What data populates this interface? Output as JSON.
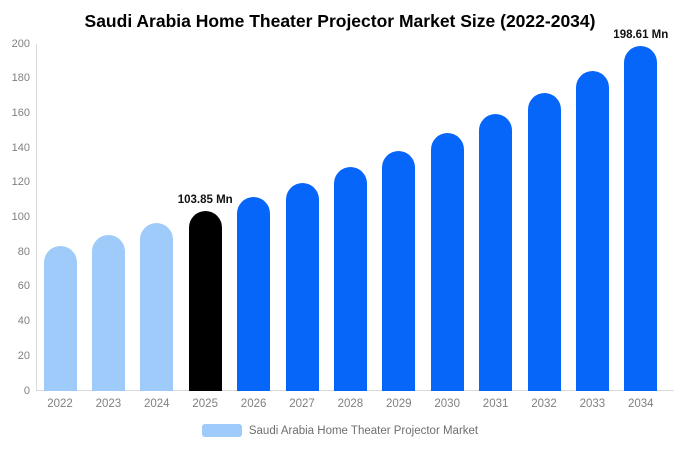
{
  "title": "Saudi Arabia Home Theater Projector Market Size (2022-2034)",
  "legend": {
    "label": "Saudi Arabia Home Theater Projector Market",
    "swatch_color": "#9ECBF9"
  },
  "colors": {
    "historical_bar": "#9ECBF9",
    "highlight_bar": "#000000",
    "forecast_bar": "#0666FA",
    "axis_line": "#d9d9d9",
    "tick_text": "#808080",
    "annotation_text": "#111111"
  },
  "chart_data": {
    "type": "bar",
    "title": "Saudi Arabia Home Theater Projector Market Size (2022-2034)",
    "xlabel": "",
    "ylabel": "",
    "unit": "Mn",
    "categories": [
      "2022",
      "2023",
      "2024",
      "2025",
      "2026",
      "2027",
      "2028",
      "2029",
      "2030",
      "2031",
      "2032",
      "2033",
      "2034"
    ],
    "values": [
      83.7,
      89.9,
      96.6,
      103.85,
      111.6,
      119.9,
      128.9,
      138.5,
      148.8,
      159.9,
      171.9,
      184.7,
      198.61
    ],
    "bar_colors": [
      "#9ECBF9",
      "#9ECBF9",
      "#9ECBF9",
      "#000000",
      "#0666FA",
      "#0666FA",
      "#0666FA",
      "#0666FA",
      "#0666FA",
      "#0666FA",
      "#0666FA",
      "#0666FA",
      "#0666FA"
    ],
    "annotations": [
      {
        "category": "2025",
        "text": "103.85 Mn"
      },
      {
        "category": "2034",
        "text": "198.61 Mn"
      }
    ],
    "ylim": [
      0,
      200
    ],
    "yticks": [
      0,
      20,
      40,
      60,
      80,
      100,
      120,
      140,
      160,
      180,
      200
    ],
    "grid": false,
    "legend_position": "bottom",
    "legend_entries": [
      "Saudi Arabia Home Theater Projector Market"
    ]
  }
}
